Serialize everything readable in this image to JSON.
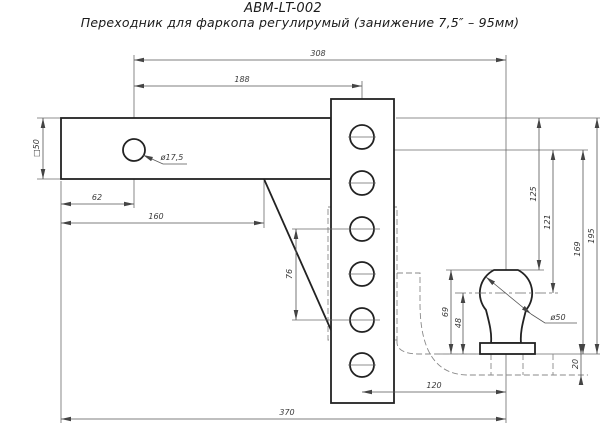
{
  "title": {
    "model": "ABM-LT-002",
    "description": "Переходник для фаркопа регулирумый (занижение 7,5″ – 95мм)"
  },
  "dimensions": {
    "span_hole_to_ball": "308",
    "span_hole_to_plate": "188",
    "hole_offset": "62",
    "shank_length": "160",
    "shank_square": "□50",
    "shank_hole_dia": "ø17,5",
    "plate_hole_spacing": "76",
    "drop_top_to_balltop": "125",
    "drop_center_to_ballcenter": "121",
    "drop_center_to_base": "169",
    "drop_top_to_base": "195",
    "ball_total_height": "69",
    "ball_center_height": "48",
    "ball_dia": "ø50",
    "tube_thickness": "20",
    "ball_offset": "120",
    "total_length": "370"
  }
}
